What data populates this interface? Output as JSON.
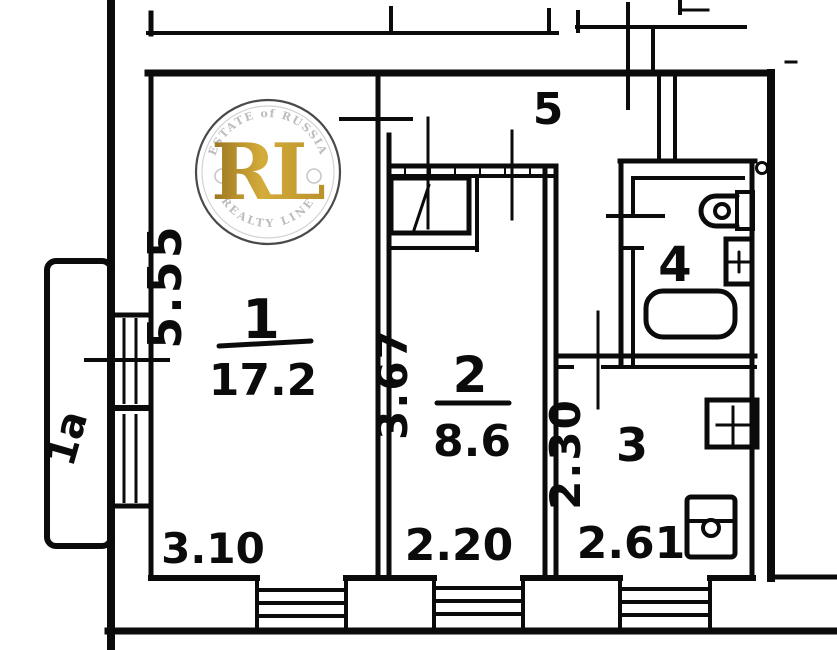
{
  "plan": {
    "title": "apartment floor plan",
    "rooms": [
      {
        "id": "room-1",
        "number": "1",
        "area": "17.2",
        "width": "3.10",
        "height": "5.55"
      },
      {
        "id": "room-2",
        "number": "2",
        "area": "8.6",
        "width": "2.20",
        "height": "3.67"
      },
      {
        "id": "room-3",
        "number": "3",
        "width": "2.61",
        "height": "2.30"
      },
      {
        "id": "room-4",
        "number": "4"
      },
      {
        "id": "room-5",
        "number": "5"
      },
      {
        "id": "balcony",
        "number": "1a"
      }
    ]
  },
  "watermark": {
    "arc_top": "ESTATE of RUSSIA",
    "arc_bottom": "REALTY LINE",
    "monogram": "RL"
  },
  "colors": {
    "ink": "#0b0b0b",
    "paper": "#ffffff",
    "gold_dark": "#9a7420",
    "gold_mid": "#d4ac3a",
    "gold_deep": "#b8922a",
    "stamp_gray": "#bdbdbd",
    "stamp_ring": "#4a4a4a"
  }
}
